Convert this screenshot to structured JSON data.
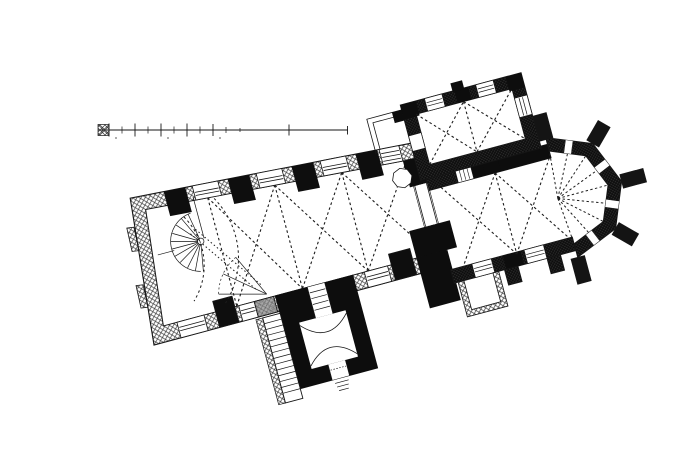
{
  "figure": {
    "title": "Engraved ground plan of a Gothic church",
    "description": "Black ink engraving on white paper: floor plan of a medieval church drawn at a tilted angle. A rectangular nave with three bays of dashed rib-vault diagonals and a western bay with dashed gallery arcs and a spiral staircase in the north-west corner; a square bell tower with massive black walls and a side staircase attached to the south wall; a chancel arch with black piers leading to a two-bay choir; a polygonal apse with five radiating buttresses and dashed radial vault ribs; a rib-vaulted sacristy chapel on the north side with a small thin-walled annex; a small thin-walled porch on the south side of the choir; a graphic scale bar with tick divisions at the upper left (numerals illegible).",
    "ink_color": "#161616",
    "paper_color": "#ffffff",
    "wall_fill_light": "crosshatch",
    "wall_fill_dark": "dense crosshatch",
    "pier_fill": "solid black"
  },
  "scale_bar": {
    "major_divisions": 10,
    "numerals_legible": false
  },
  "components": {
    "nave": {
      "label": "nave",
      "vault_bays": 3,
      "north_windows": 4,
      "south_windows": 3,
      "blocked_window": 1
    },
    "west_gallery": {
      "label": "west gallery",
      "dashed_arcs": 2,
      "fan_lines": 3
    },
    "spiral_staircase": {
      "label": "spiral staircase",
      "location": "north-west corner of nave"
    },
    "tower": {
      "label": "bell tower",
      "location": "south side of nave",
      "features": [
        "thick black walls",
        "interior vault arcs",
        "side staircase",
        "north door with steps",
        "south door with steps"
      ]
    },
    "chancel": {
      "label": "chancel arch",
      "features": [
        "black piers",
        "pulpit octagon",
        "rood stair fan"
      ]
    },
    "choir": {
      "label": "choir",
      "vault_bays": 2,
      "south_windows": 2,
      "south_buttresses": 2
    },
    "apse": {
      "label": "polygonal apse",
      "sides": 5,
      "buttresses": 5,
      "windows": 4,
      "radial_ribs": 9
    },
    "sacristy": {
      "label": "north sacristy chapel",
      "vault_bays": 2,
      "north_windows": 2,
      "east_window": 1
    },
    "west_annex": {
      "label": "thin-walled annex west of sacristy"
    },
    "south_porch": {
      "label": "thin-walled south porch at choir"
    }
  }
}
